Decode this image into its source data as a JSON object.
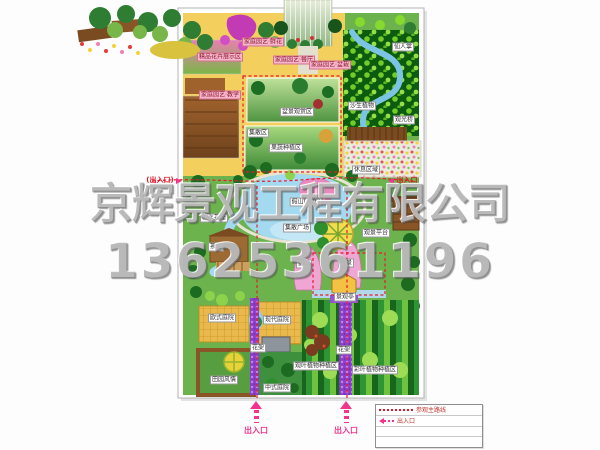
{
  "watermark": {
    "company": "京辉景观工程有限公司",
    "phone": "13625361196"
  },
  "colors": {
    "route": "#e01828",
    "entrance_arrow": "#f2358c",
    "watermark_gray": "#878787",
    "zone_yellow": "#f3cf5d",
    "water_blue": "#a4daf0",
    "forest_green": "#0c5c10"
  },
  "entrances": {
    "left": {
      "label": "(出入口)"
    },
    "right": {
      "label": "出入口"
    },
    "bottom": [
      {
        "label": "出入口"
      },
      {
        "label": "出入口"
      }
    ]
  },
  "legend": {
    "route_label": "参观主路线",
    "entrance_label": "出入口",
    "route_symbol": "dashed-route-line",
    "entrance_symbol": "entrance-arrow"
  },
  "map_labels": [
    {
      "t": "精品花卉展示区",
      "x": 220,
      "y": 57,
      "s": "pink"
    },
    {
      "t": "家庭园艺·鲜花",
      "x": 263,
      "y": 42,
      "s": "pink"
    },
    {
      "t": "家庭园艺·餐厅",
      "x": 294,
      "y": 60,
      "s": "pink"
    },
    {
      "t": "家庭园艺·盆栽",
      "x": 330,
      "y": 65,
      "s": "pink"
    },
    {
      "t": "家庭园艺·教学",
      "x": 220,
      "y": 95,
      "s": "pink"
    },
    {
      "t": "集散区",
      "x": 258,
      "y": 133,
      "s": "white"
    },
    {
      "t": "盆景观赏区",
      "x": 297,
      "y": 112,
      "s": "white"
    },
    {
      "t": "果蔬种植区",
      "x": 286,
      "y": 148,
      "s": "white"
    },
    {
      "t": "仙人掌",
      "x": 403,
      "y": 47,
      "s": "white"
    },
    {
      "t": "沙生植物",
      "x": 362,
      "y": 106,
      "s": "white"
    },
    {
      "t": "观光桥",
      "x": 404,
      "y": 120,
      "s": "white"
    },
    {
      "t": "休息区域",
      "x": 366,
      "y": 170,
      "s": "white"
    },
    {
      "t": "临水茶座",
      "x": 214,
      "y": 218,
      "s": "white"
    },
    {
      "t": "茶室",
      "x": 216,
      "y": 247,
      "s": "white"
    },
    {
      "t": "假山(瀑布)",
      "x": 306,
      "y": 202,
      "s": "white"
    },
    {
      "t": "集散广场",
      "x": 297,
      "y": 228,
      "s": "white"
    },
    {
      "t": "观景平台",
      "x": 376,
      "y": 233,
      "s": "white"
    },
    {
      "t": "假山",
      "x": 304,
      "y": 264,
      "s": "white"
    },
    {
      "t": "观景",
      "x": 346,
      "y": 263,
      "s": "white"
    },
    {
      "t": "景观亭",
      "x": 345,
      "y": 297,
      "s": "white"
    },
    {
      "t": "欧式庭院",
      "x": 222,
      "y": 318,
      "s": "white"
    },
    {
      "t": "现代庭院",
      "x": 277,
      "y": 320,
      "s": "white"
    },
    {
      "t": "花架",
      "x": 258,
      "y": 348,
      "s": "white"
    },
    {
      "t": "田园风情",
      "x": 224,
      "y": 380,
      "s": "white"
    },
    {
      "t": "中式庭院",
      "x": 277,
      "y": 388,
      "s": "white"
    },
    {
      "t": "花架",
      "x": 344,
      "y": 350,
      "s": "white"
    },
    {
      "t": "观叶植物种植区",
      "x": 316,
      "y": 366,
      "s": "white"
    },
    {
      "t": "彩叶植物种植区",
      "x": 375,
      "y": 370,
      "s": "white"
    }
  ]
}
